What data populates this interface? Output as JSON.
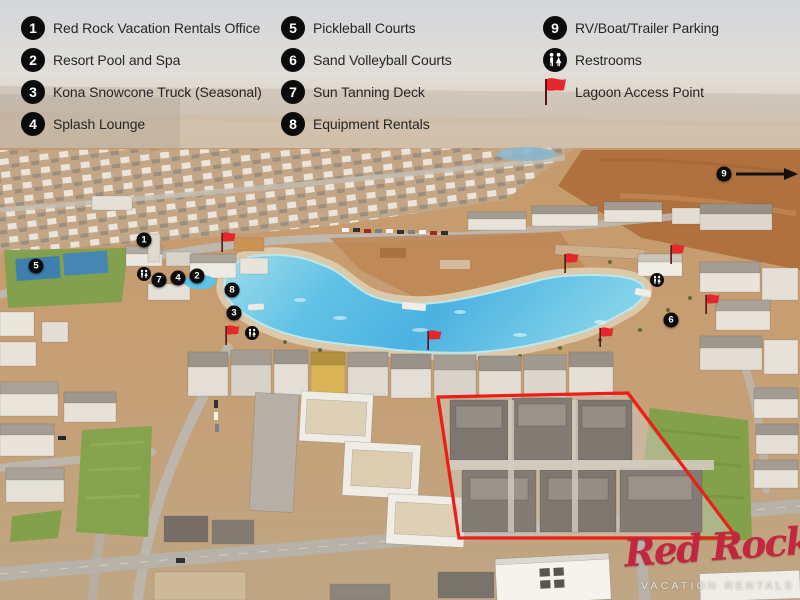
{
  "legend": {
    "columns": [
      {
        "items": [
          {
            "type": "number",
            "num": "1",
            "label": "Red Rock Vacation Rentals Office"
          },
          {
            "type": "number",
            "num": "2",
            "label": "Resort Pool and Spa"
          },
          {
            "type": "number",
            "num": "3",
            "label": "Kona Snowcone Truck (Seasonal)"
          },
          {
            "type": "number",
            "num": "4",
            "label": "Splash Lounge"
          }
        ]
      },
      {
        "items": [
          {
            "type": "number",
            "num": "5",
            "label": "Pickleball Courts"
          },
          {
            "type": "number",
            "num": "6",
            "label": "Sand Volleyball Courts"
          },
          {
            "type": "number",
            "num": "7",
            "label": "Sun Tanning Deck"
          },
          {
            "type": "number",
            "num": "8",
            "label": "Equipment Rentals"
          }
        ]
      },
      {
        "items": [
          {
            "type": "number",
            "num": "9",
            "label": "RV/Boat/Trailer Parking"
          },
          {
            "type": "restrooms",
            "label": "Restrooms"
          },
          {
            "type": "flag",
            "label": "Lagoon Access Point"
          }
        ]
      }
    ]
  },
  "map": {
    "markers": [
      {
        "num": "1",
        "x": 144,
        "y": 240
      },
      {
        "num": "2",
        "x": 197,
        "y": 276
      },
      {
        "num": "3",
        "x": 234,
        "y": 313
      },
      {
        "num": "4",
        "x": 178,
        "y": 278
      },
      {
        "num": "5",
        "x": 36,
        "y": 266
      },
      {
        "num": "6",
        "x": 671,
        "y": 320
      },
      {
        "num": "7",
        "x": 159,
        "y": 280
      },
      {
        "num": "8",
        "x": 232,
        "y": 290
      },
      {
        "num": "9",
        "x": 724,
        "y": 174,
        "arrow": true
      }
    ],
    "restrooms": [
      {
        "x": 144,
        "y": 274
      },
      {
        "x": 252,
        "y": 333
      },
      {
        "x": 657,
        "y": 280
      }
    ],
    "flags": [
      {
        "x": 228,
        "y": 242
      },
      {
        "x": 571,
        "y": 263
      },
      {
        "x": 677,
        "y": 254
      },
      {
        "x": 712,
        "y": 304
      },
      {
        "x": 434,
        "y": 340
      },
      {
        "x": 606,
        "y": 337
      },
      {
        "x": 232,
        "y": 335
      }
    ]
  },
  "logo": {
    "title": "Red Rock",
    "subtitle": "VACATION RENTALS"
  },
  "colors": {
    "marker_bg": "#0c0c0c",
    "marker_text": "#ffffff",
    "flag_red": "#e32227",
    "parcel_outline_red": "#ee1d18",
    "logo_red": "#c32740",
    "lagoon_blue": "#4cb6e5",
    "desert_tan": "#c59a6c"
  }
}
